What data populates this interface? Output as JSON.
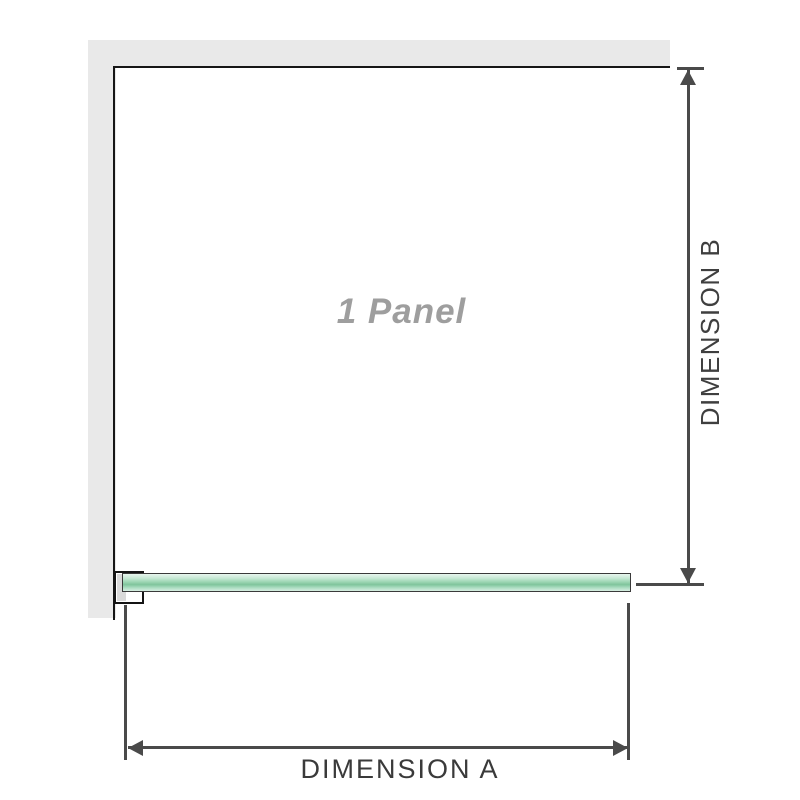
{
  "diagram": {
    "panel_label": "1 Panel",
    "dimension_a_label": "DIMENSION A",
    "dimension_b_label": "DIMENSION B"
  },
  "icons": {
    "dimension_b_top": "arrow-up-icon",
    "dimension_b_bottom": "arrow-down-icon",
    "dimension_a_left": "arrow-left-icon",
    "dimension_a_right": "arrow-right-icon"
  },
  "colors": {
    "wall_gray": "#e9e9e9",
    "panel_outline": "#161616",
    "dimension_line": "#4a4a4a",
    "panel_label_gray": "#9e9e9e",
    "glass_green": "#8fceaa",
    "glass_green_light": "#e8f5ee",
    "bracket_fill": "#d9d9d9"
  }
}
